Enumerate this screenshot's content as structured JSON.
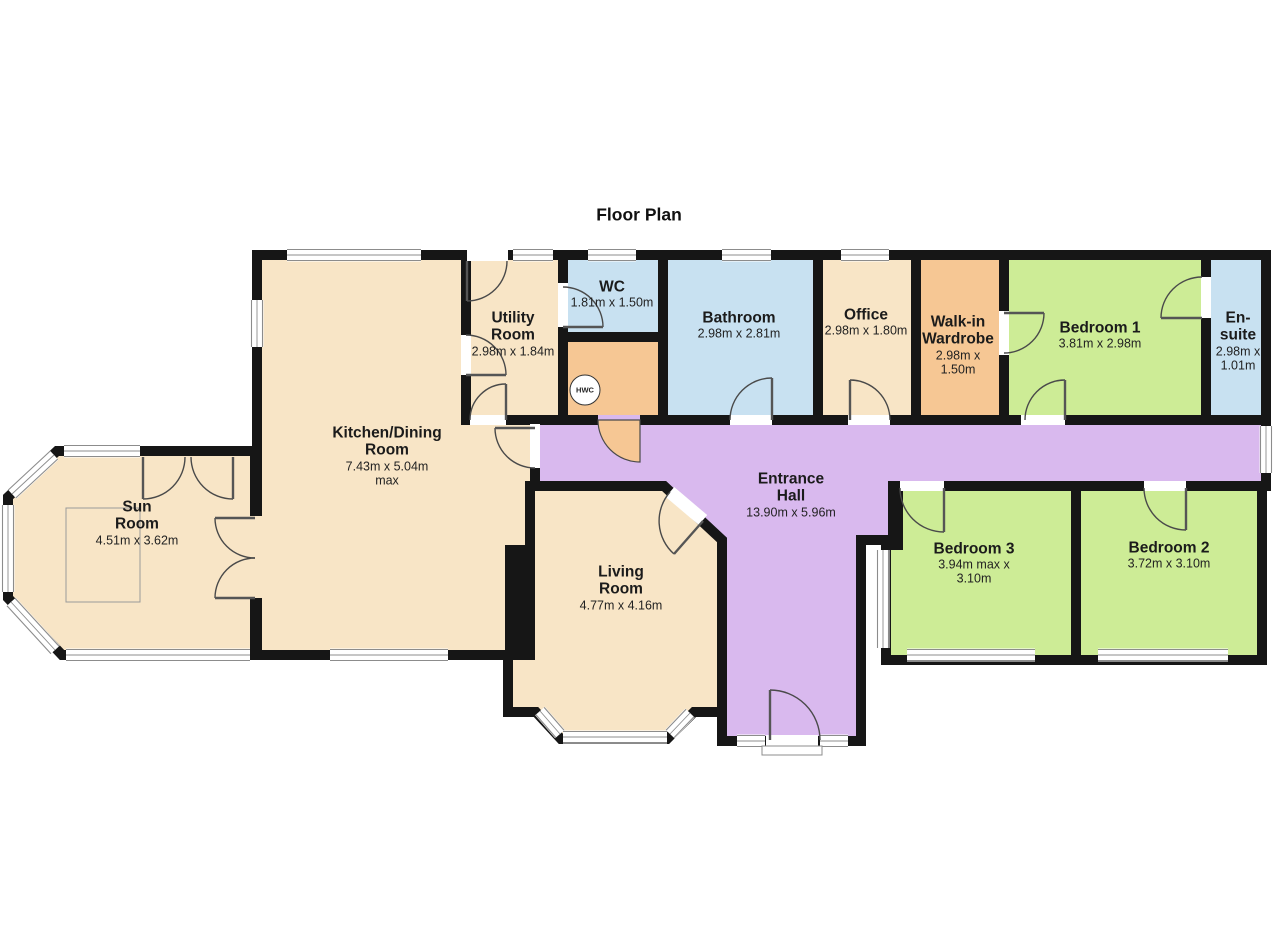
{
  "title": "Floor Plan",
  "rooms": {
    "sun_room": {
      "name": "Sun Room",
      "dims": "4.51m x 3.62m"
    },
    "kitchen": {
      "name": "Kitchen/Dining Room",
      "dims": "7.43m x 5.04m max"
    },
    "utility": {
      "name": "Utility Room",
      "dims": "2.98m x 1.84m"
    },
    "wc": {
      "name": "WC",
      "dims": "1.81m x 1.50m"
    },
    "bathroom": {
      "name": "Bathroom",
      "dims": "2.98m x 2.81m"
    },
    "office": {
      "name": "Office",
      "dims": "2.98m x 1.80m"
    },
    "wardrobe": {
      "name": "Walk-in Wardrobe",
      "dims": "2.98m x 1.50m"
    },
    "bedroom1": {
      "name": "Bedroom 1",
      "dims": "3.81m x 2.98m"
    },
    "ensuite": {
      "name": "En-suite",
      "dims": "2.98m x 1.01m"
    },
    "hall": {
      "name": "Entrance Hall",
      "dims": "13.90m x 5.96m"
    },
    "living": {
      "name": "Living Room",
      "dims": "4.77m x 4.16m"
    },
    "bedroom3": {
      "name": "Bedroom 3",
      "dims": "3.94m max x 3.10m"
    },
    "bedroom2": {
      "name": "Bedroom 2",
      "dims": "3.72m x 3.10m"
    },
    "hwc": {
      "label": "HWC"
    }
  },
  "colors": {
    "cream": "#F8E5C6",
    "blue": "#C8E1F1",
    "green": "#CDEC96",
    "purple": "#D9B9EE",
    "orange": "#F6C794",
    "wall": "#161616",
    "win": "#8C8C8C",
    "door": "#4a4a4a"
  }
}
